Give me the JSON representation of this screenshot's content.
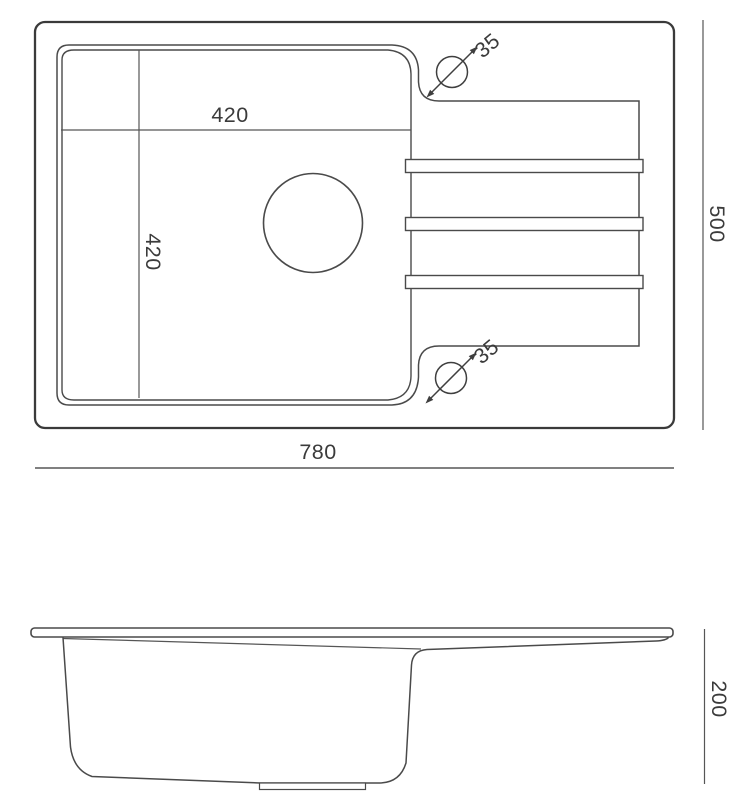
{
  "drawing_type": "kitchen sink technical dimension drawing",
  "top_view": {
    "dimensions": {
      "overall_width": "780",
      "overall_depth": "500",
      "bowl_width": "420",
      "bowl_depth": "420",
      "tap_hole_top_diameter": "35",
      "tap_hole_bottom_diameter": "35"
    },
    "features": [
      "bowl",
      "drain-hole",
      "drainboard-with-3-ribs",
      "tap-hole-top",
      "tap-hole-bottom"
    ]
  },
  "side_view": {
    "dimensions": {
      "overall_height": "200"
    },
    "features": [
      "rim",
      "bowl-profile",
      "drain-boss"
    ]
  },
  "colors": {
    "background": "#ffffff",
    "outer_outline": "#3a3a3a",
    "line": "#4a4a4a",
    "text": "#3b3b3b"
  }
}
